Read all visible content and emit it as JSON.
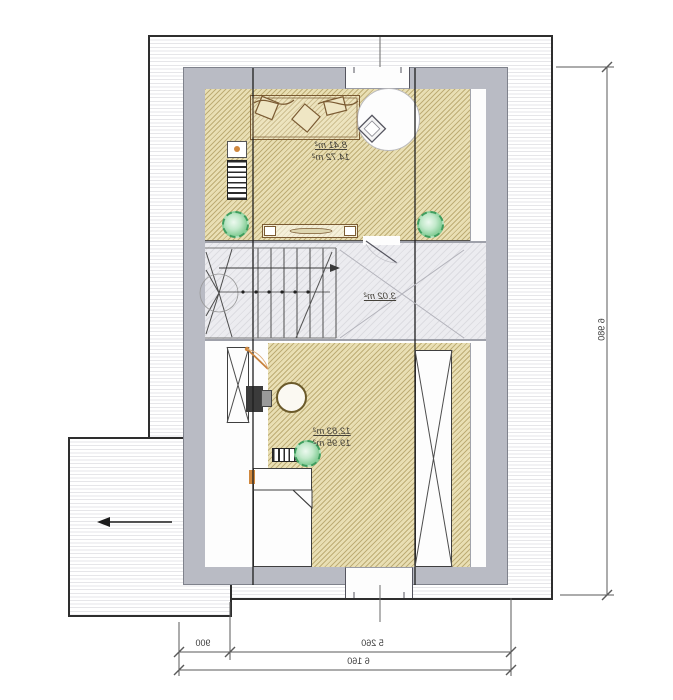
{
  "title": "attic-floor-plan",
  "rooms": [
    {
      "name": "top-room",
      "area": "8.41 m²",
      "area_full": "14.72 m²"
    },
    {
      "name": "stair-hall",
      "area": "3.02 m²"
    },
    {
      "name": "bottom-room",
      "area": "12.83 m²",
      "area_full": "19.95 m²"
    }
  ],
  "dimensions": {
    "bottom_segment_left": "900",
    "bottom_segment_main": "5 260",
    "bottom_total": "6 160",
    "right_total": "6 980"
  },
  "colors": {
    "wall": "#b9bbc4",
    "floor": "#e9dfb4",
    "hall_floor": "#ececf0",
    "plant_green": "#74c488",
    "door_accent": "#d0883e",
    "outline": "#2e2e2e"
  },
  "icons": {
    "slope_arrow": "roof-slope-arrow",
    "plant": "plant-icon",
    "stair": "stair-run-icon",
    "radiator": "radiator-icon",
    "shaft_cross": "x-brace-icon"
  }
}
